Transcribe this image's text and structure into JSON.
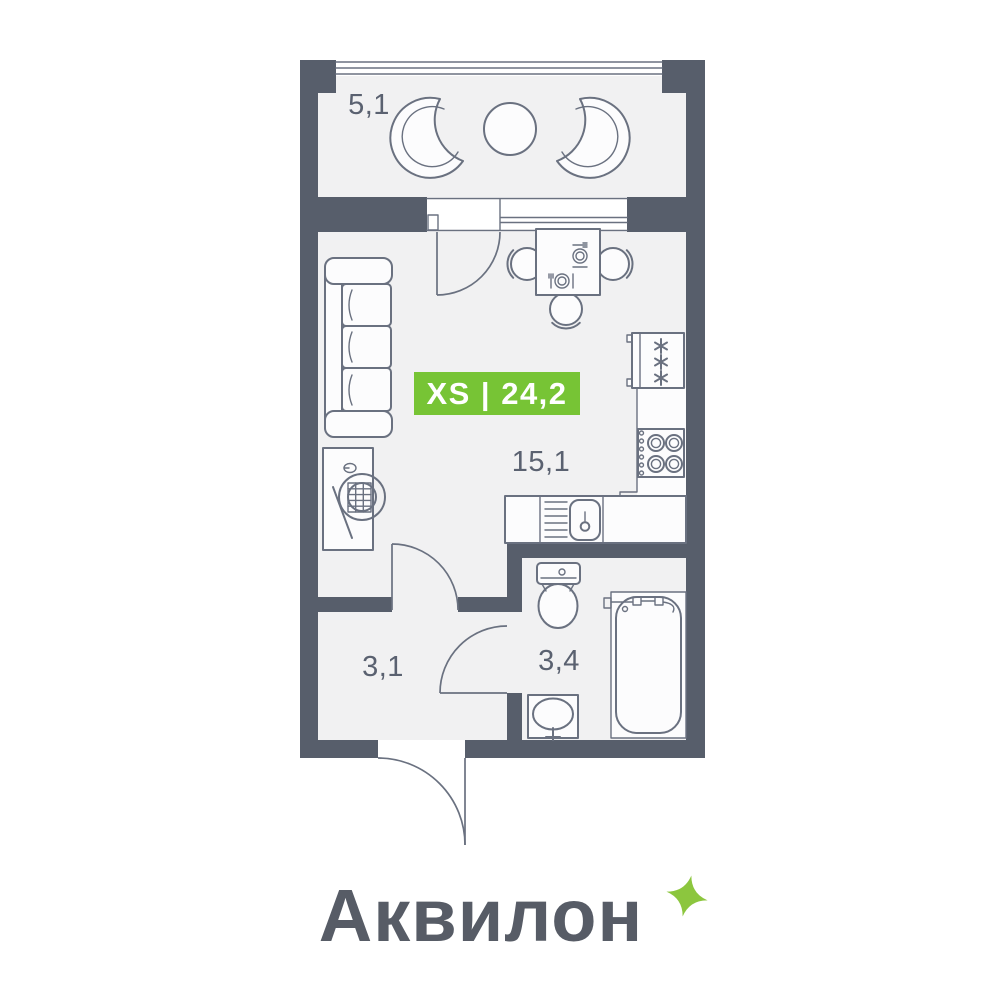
{
  "colors": {
    "wall": "#575E6B",
    "floor": "#F1F1F2",
    "line": "#6A7180",
    "fill": "#FCFCFD",
    "label": "#5A6170",
    "badge": "#77C435",
    "logo": "#575C66",
    "sparkle": "#8CC63E"
  },
  "badge": {
    "text": "XS | 24,2"
  },
  "rooms": {
    "balcony": {
      "area": "5,1"
    },
    "living": {
      "area": "15,1"
    },
    "hallway": {
      "area": "3,1"
    },
    "bathroom": {
      "area": "3,4"
    }
  },
  "logo": {
    "wordmark": "Аквилон"
  }
}
